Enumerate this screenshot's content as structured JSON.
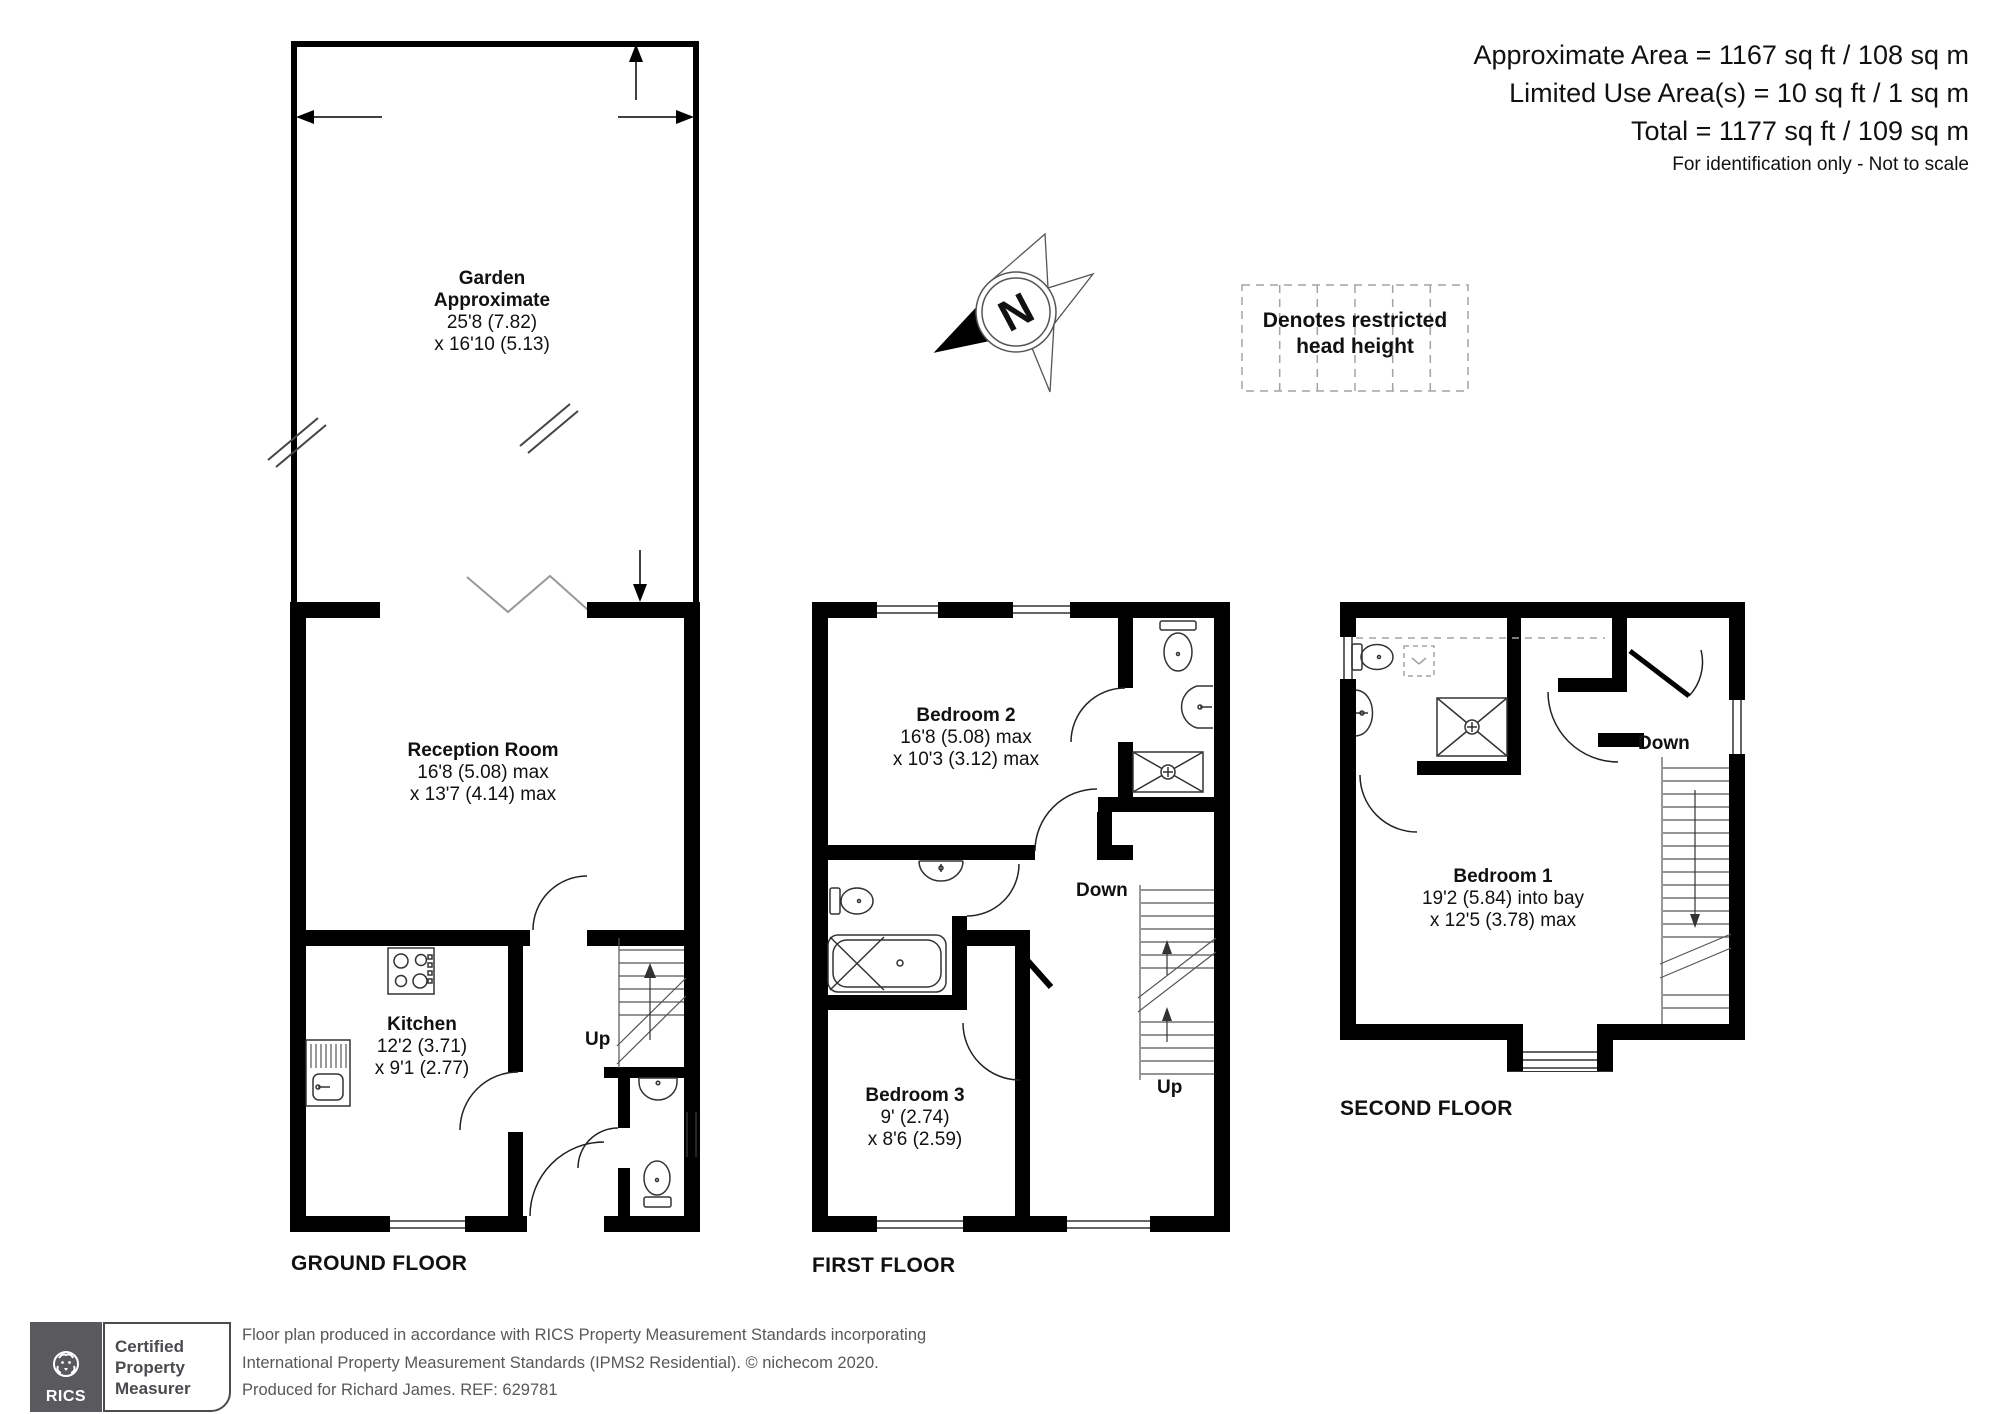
{
  "header": {
    "line1": "Approximate Area = 1167 sq ft / 108 sq m",
    "line2": "Limited Use Area(s) = 10 sq ft / 1 sq m",
    "line3": "Total = 1177 sq ft / 109 sq m",
    "note": "For identification only - Not to scale"
  },
  "legend": {
    "line1": "Denotes restricted",
    "line2": "head height"
  },
  "compass": {
    "letter": "N"
  },
  "floors": {
    "ground": {
      "name": "GROUND FLOOR",
      "garden": {
        "name": "Garden",
        "sub": "Approximate",
        "dim1": "25'8 (7.82)",
        "dim2": "x 16'10 (5.13)"
      },
      "reception": {
        "name": "Reception Room",
        "dim1": "16'8 (5.08) max",
        "dim2": "x 13'7 (4.14) max"
      },
      "kitchen": {
        "name": "Kitchen",
        "dim1": "12'2 (3.71)",
        "dim2": "x 9'1 (2.77)"
      },
      "up": "Up"
    },
    "first": {
      "name": "FIRST FLOOR",
      "bedroom2": {
        "name": "Bedroom 2",
        "dim1": "16'8 (5.08) max",
        "dim2": "x 10'3 (3.12) max"
      },
      "bedroom3": {
        "name": "Bedroom 3",
        "dim1": "9' (2.74)",
        "dim2": "x 8'6 (2.59)"
      },
      "down": "Down",
      "up": "Up"
    },
    "second": {
      "name": "SECOND FLOOR",
      "bedroom1": {
        "name": "Bedroom 1",
        "dim1": "19'2 (5.84) into bay",
        "dim2": "x 12'5 (3.78) max"
      },
      "down": "Down"
    }
  },
  "footer": {
    "rics": "RICS",
    "badge": [
      "Certified",
      "Property",
      "Measurer"
    ],
    "line1": "Floor plan produced in accordance with RICS Property Measurement Standards incorporating",
    "line2": "International Property Measurement Standards (IPMS2 Residential).   © nichecom 2020.",
    "line3": "Produced for Richard James.   REF:  629781"
  },
  "colors": {
    "wall": "#000000",
    "fixture": "#333333",
    "stair_line": "#555555",
    "dash": "#a3a3a3",
    "footer_text": "#57585a",
    "rics_bg": "#5a5a5e"
  }
}
